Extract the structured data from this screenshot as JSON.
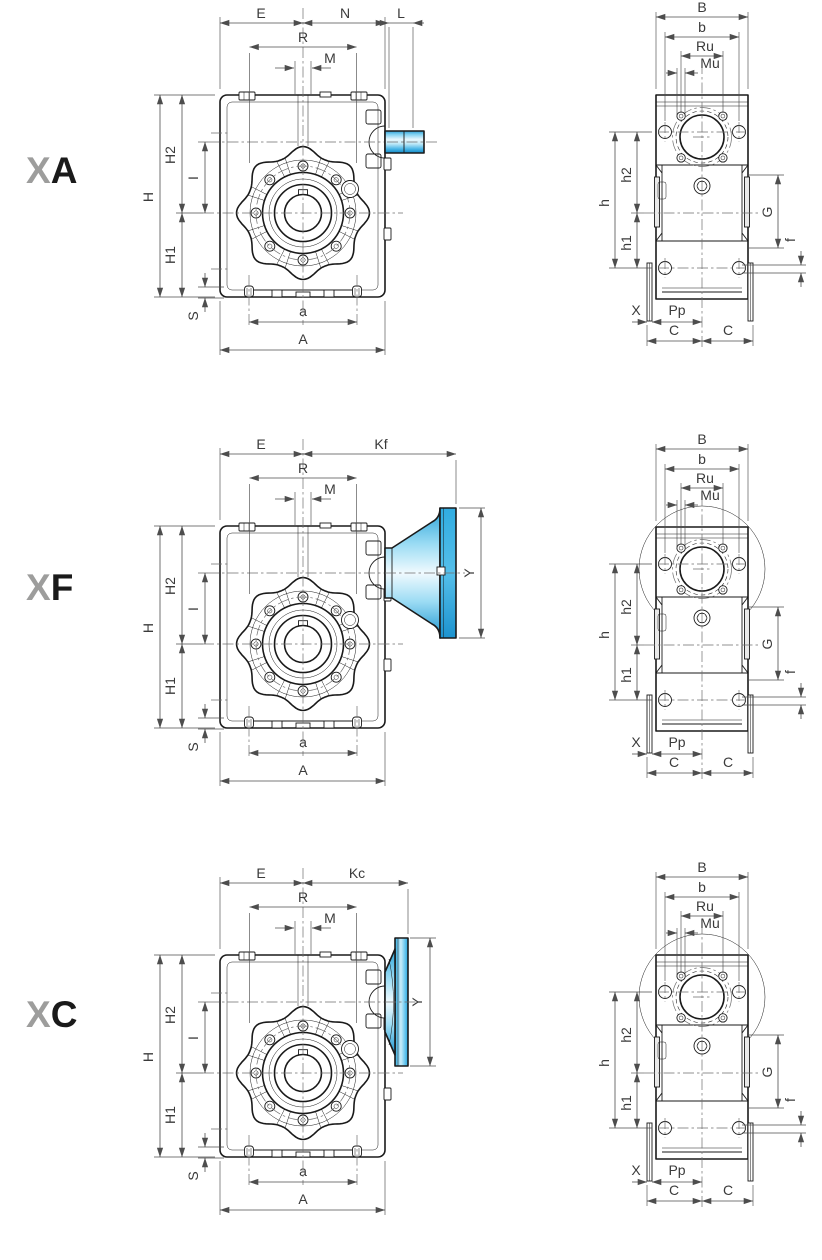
{
  "rows": [
    {
      "code_x": "X",
      "code_letter": "A",
      "front": {
        "E": "E",
        "N": "N",
        "L": "L",
        "R": "R",
        "M": "M",
        "H": "H",
        "H2": "H2",
        "H1": "H1",
        "I": "I",
        "S": "S",
        "a": "a",
        "A": "A"
      },
      "side": {
        "B": "B",
        "b": "b",
        "Ru": "Ru",
        "Mu": "Mu",
        "h": "h",
        "h2": "h2",
        "h1": "h1",
        "G": "G",
        "f": "f",
        "X": "X",
        "Pp": "Pp",
        "C_left": "C",
        "C_right": "C"
      }
    },
    {
      "code_x": "X",
      "code_letter": "F",
      "front": {
        "E": "E",
        "Kf": "Kf",
        "R": "R",
        "M": "M",
        "H": "H",
        "H2": "H2",
        "H1": "H1",
        "I": "I",
        "S": "S",
        "a": "a",
        "A": "A",
        "Y": "Y"
      },
      "side": {
        "B": "B",
        "b": "b",
        "Ru": "Ru",
        "Mu": "Mu",
        "h": "h",
        "h2": "h2",
        "h1": "h1",
        "G": "G",
        "f": "f",
        "X": "X",
        "Pp": "Pp",
        "C_left": "C",
        "C_right": "C"
      }
    },
    {
      "code_x": "X",
      "code_letter": "C",
      "front": {
        "E": "E",
        "Kc": "Kc",
        "R": "R",
        "M": "M",
        "H": "H",
        "H2": "H2",
        "H1": "H1",
        "I": "I",
        "S": "S",
        "a": "a",
        "A": "A",
        "Y": "Y"
      },
      "side": {
        "B": "B",
        "b": "b",
        "Ru": "Ru",
        "Mu": "Mu",
        "h": "h",
        "h2": "h2",
        "h1": "h1",
        "G": "G",
        "f": "f",
        "X": "X",
        "Pp": "Pp",
        "C_left": "C",
        "C_right": "C"
      }
    }
  ],
  "colors": {
    "accent": "#29abe2",
    "accent_dark": "#1b93cf",
    "accent_pale": "#d9f1fb",
    "outline": "#1a1a1a",
    "dim_line": "#4d4d4d",
    "code_gray": "#9d9d9c",
    "label_text": "#3a3a3a",
    "background": "#ffffff"
  }
}
